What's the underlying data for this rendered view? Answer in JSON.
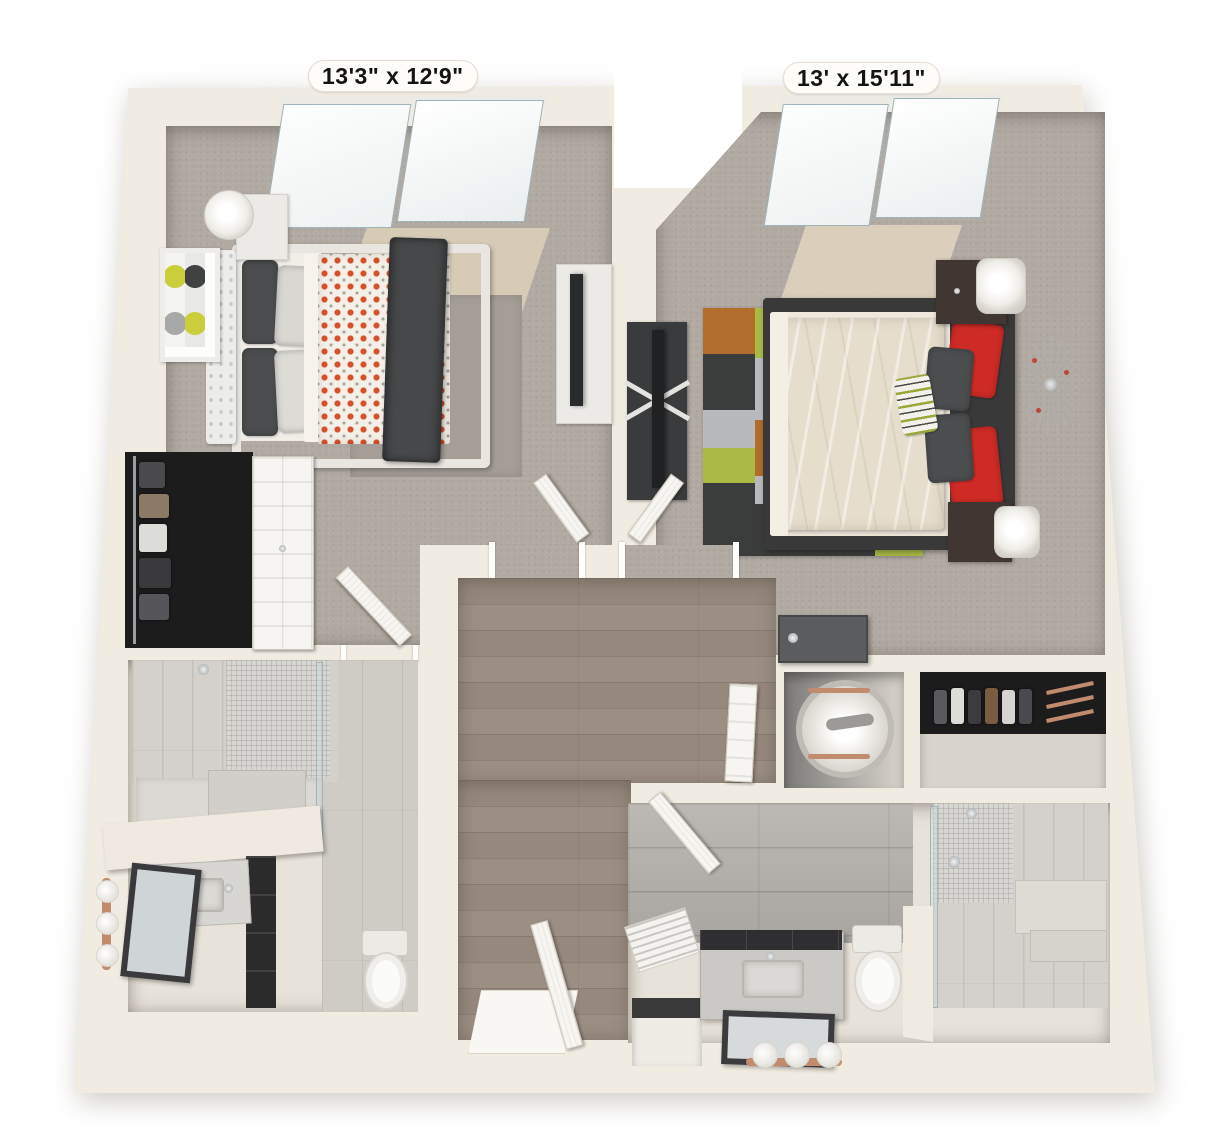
{
  "labels": {
    "bedroom1_dims": "13'3\" x 12'9\"",
    "bedroom2_dims": "13' x 15'11\""
  },
  "palette": {
    "wall_cream": "#f1ece2",
    "exterior_white": "#ffffff",
    "carpet_gray": "#b1aaa3",
    "carpet_sunlit": "#ddd1b8",
    "hall_wood": "#95887d",
    "bath_tile_wall": "#b4b1ac",
    "bath_tile_floor": "#cfccc6",
    "rug_lime": "#a9ba45",
    "rug_lime_light": "#c5d64d",
    "rug_orange": "#b06d2b",
    "rug_charcoal": "#3b3d3c",
    "rug_gray": "#b7babc",
    "rug_white": "#eae8e1",
    "bed1_dot_orange": "#d4512b",
    "bed1_throw_gray": "#46484a",
    "bed2_duvet_cream": "#e6decd",
    "bed2_frame_dark": "#383938",
    "pillow_red": "#cf2b26",
    "pillow_charcoal": "#4b4d4f",
    "towel_copper": "#c18b6e",
    "door_white": "#f6f5f1",
    "sliding_door_gray": "#5a5c5e",
    "furniture_dark": "#3a3b3d",
    "nightstand_brown": "#413732"
  }
}
